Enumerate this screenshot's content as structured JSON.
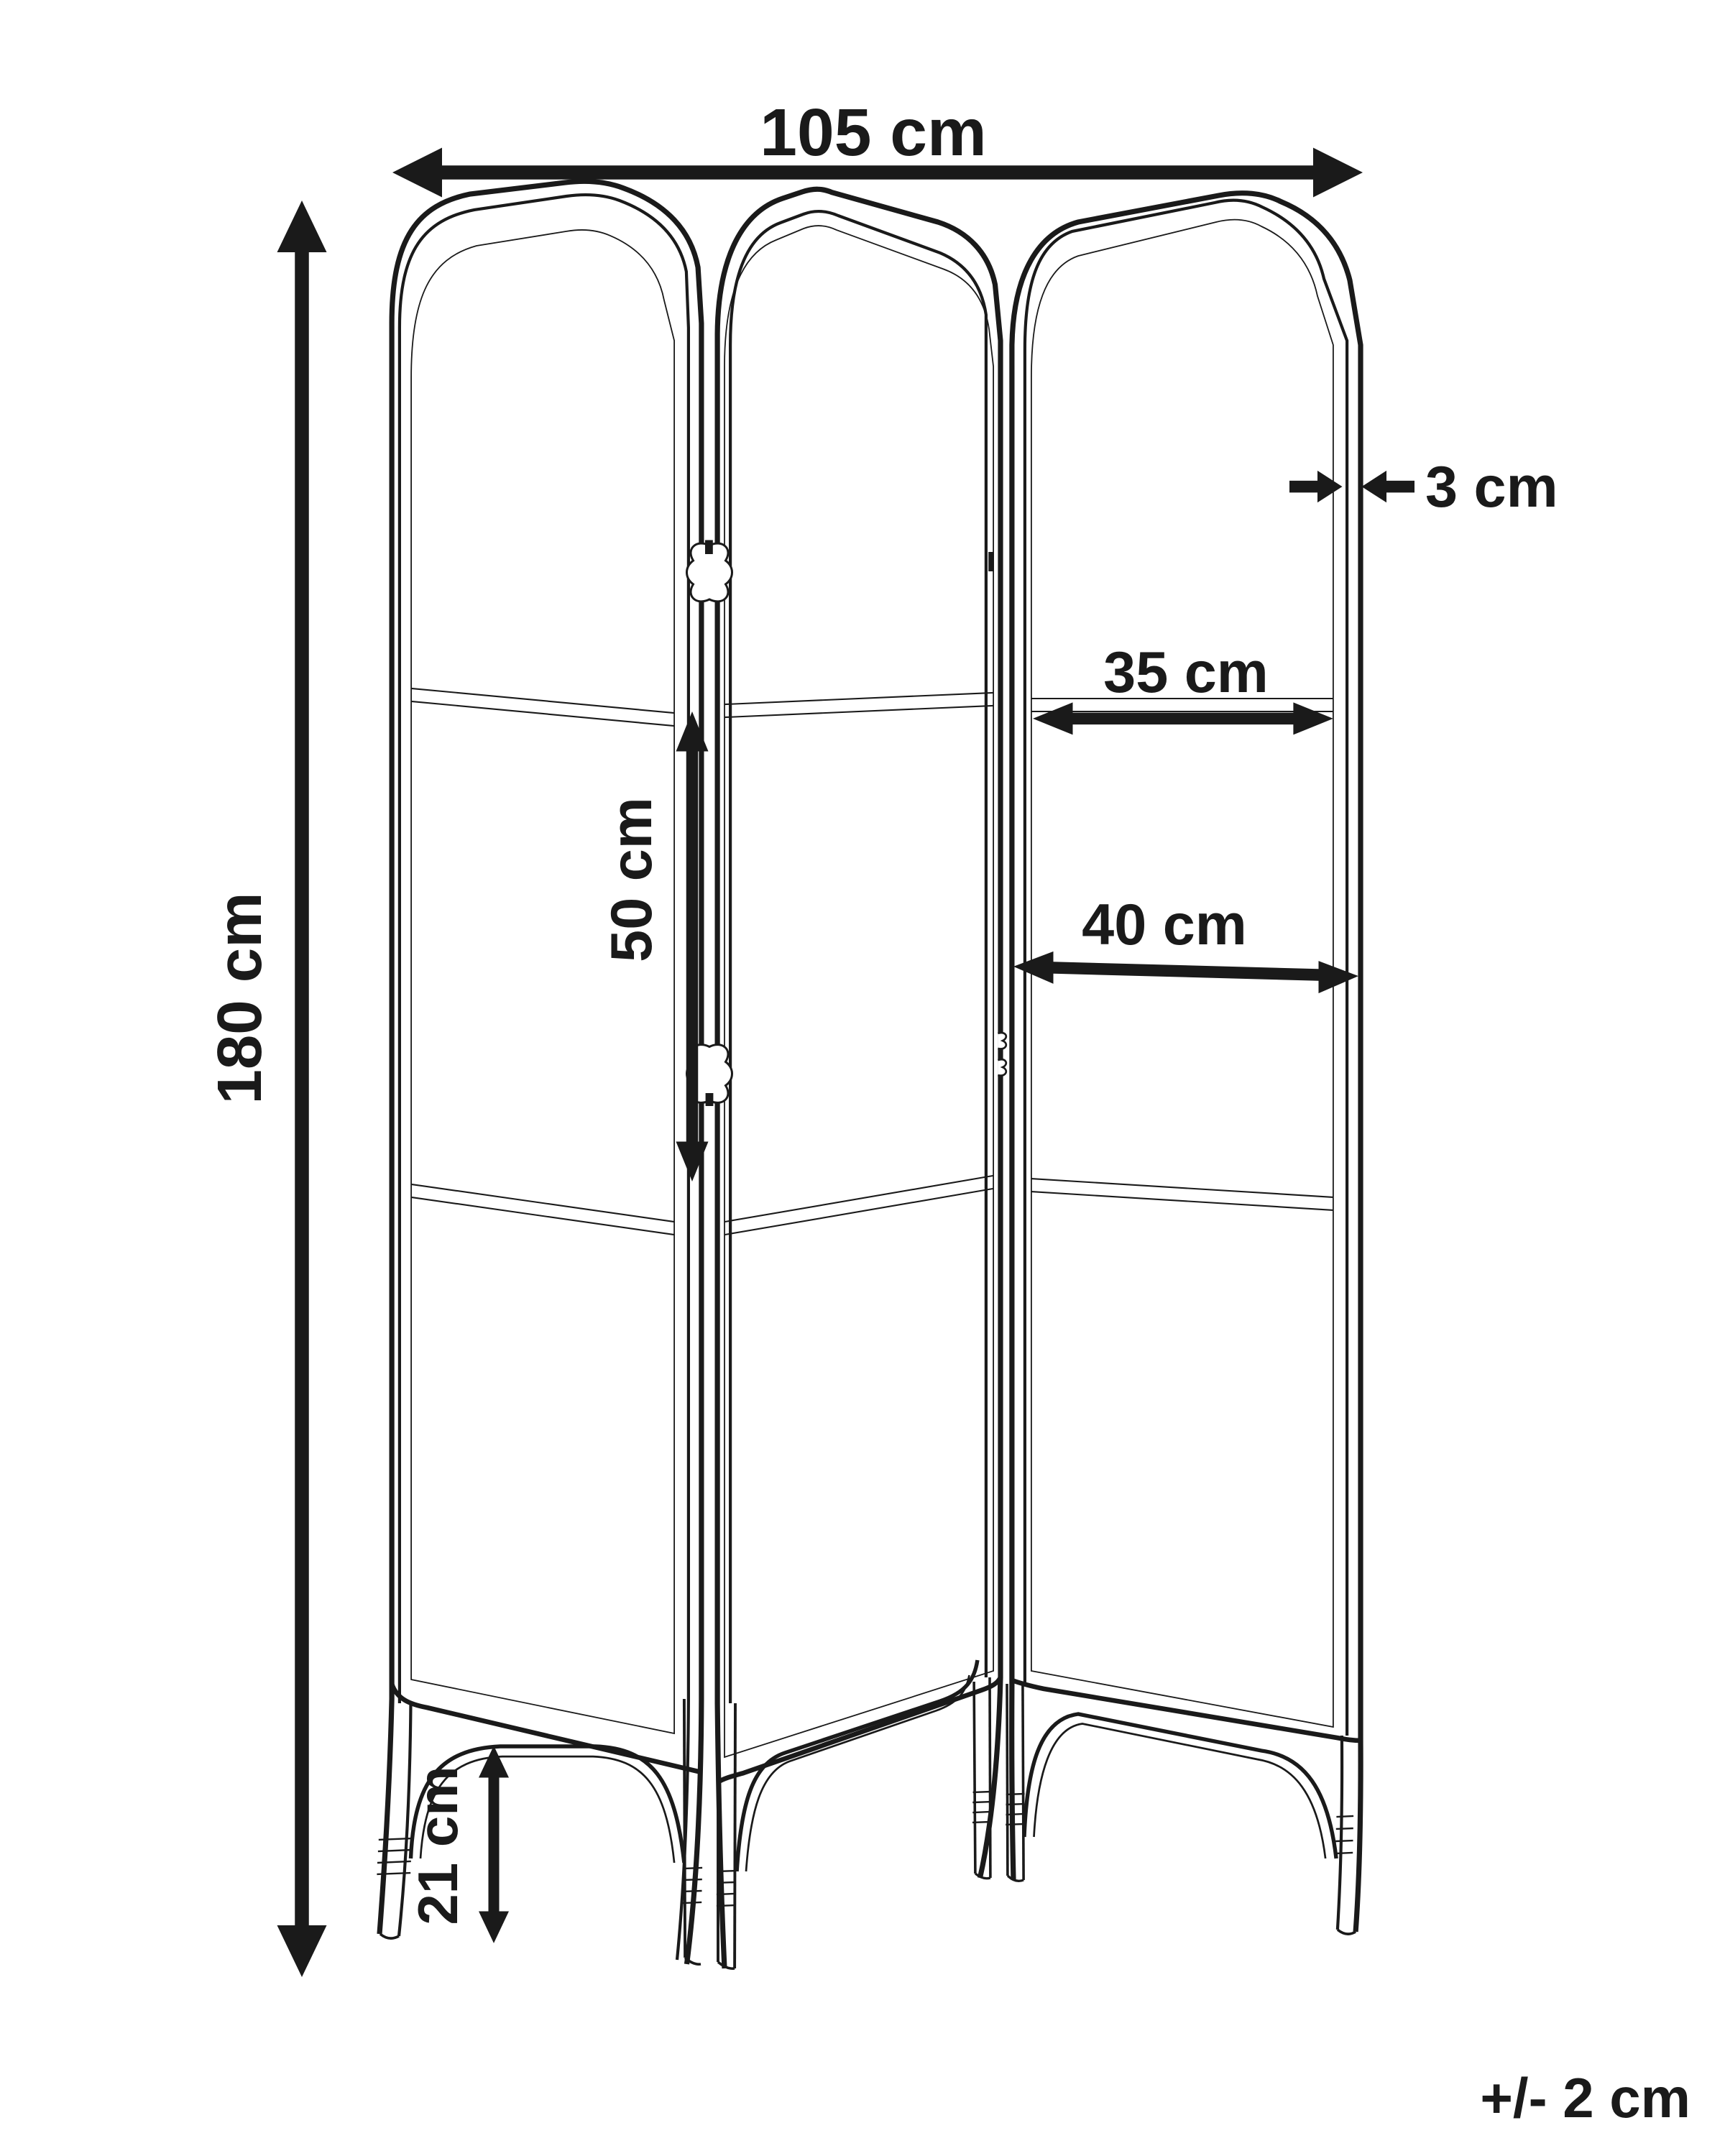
{
  "figure": {
    "subject": "3-panel folding screen dimension drawing",
    "background": "#ffffff",
    "line_color": "#1a1a1a"
  },
  "dimensions": {
    "total_width": {
      "label": "105 cm"
    },
    "total_height": {
      "label": "180 cm"
    },
    "frame_thickness": {
      "label": "3 cm"
    },
    "panel_inner_width": {
      "label": "35 cm"
    },
    "panel_mid_width": {
      "label": "40 cm"
    },
    "mid_section_height": {
      "label": "50 cm"
    },
    "leg_height": {
      "label": "21 cm"
    },
    "tolerance": {
      "label": "+/- 2 cm"
    }
  }
}
